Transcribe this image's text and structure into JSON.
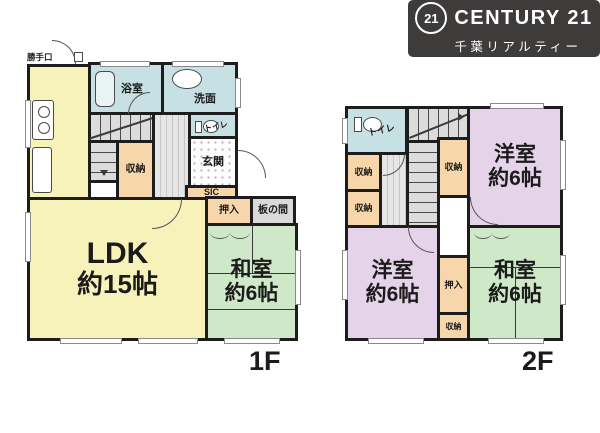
{
  "palette": {
    "wall": "#1d1d1d",
    "ldk_yellow": "#f7f2ba",
    "washitsu_green": "#cfe9c8",
    "yoshitsu_purple": "#e5d3e9",
    "storage_orange": "#f7d6ab",
    "wet_area_blue": "#c6e0e3",
    "floor_gray": "#d9d9d9",
    "logo_bg": "#3e3b3b"
  },
  "logo": {
    "mark": "21",
    "brand": "CENTURY 21",
    "company": "千葉リアルティー"
  },
  "floor1": {
    "label": "1F",
    "rooms": {
      "backdoor": "勝手口",
      "bath": "浴室",
      "washroom": "洗面",
      "toilet": "トイレ",
      "stair_closet": "収納",
      "entrance": "玄関",
      "sic": "SIC",
      "oshiire": "押入",
      "itanoma": "板の間",
      "washitsu_name": "和室",
      "washitsu_size": "約6帖",
      "ldk_name": "LDK",
      "ldk_size": "約15帖"
    }
  },
  "floor2": {
    "label": "2F",
    "rooms": {
      "toilet": "トイレ",
      "closet_a": "収納",
      "closet_b": "収納",
      "closet_c": "収納",
      "closet_d": "収納",
      "oshiire": "押入",
      "yoshitsu_a_name": "洋室",
      "yoshitsu_a_size": "約6帖",
      "yoshitsu_b_name": "洋室",
      "yoshitsu_b_size": "約6帖",
      "washitsu_name": "和室",
      "washitsu_size": "約6帖"
    }
  }
}
